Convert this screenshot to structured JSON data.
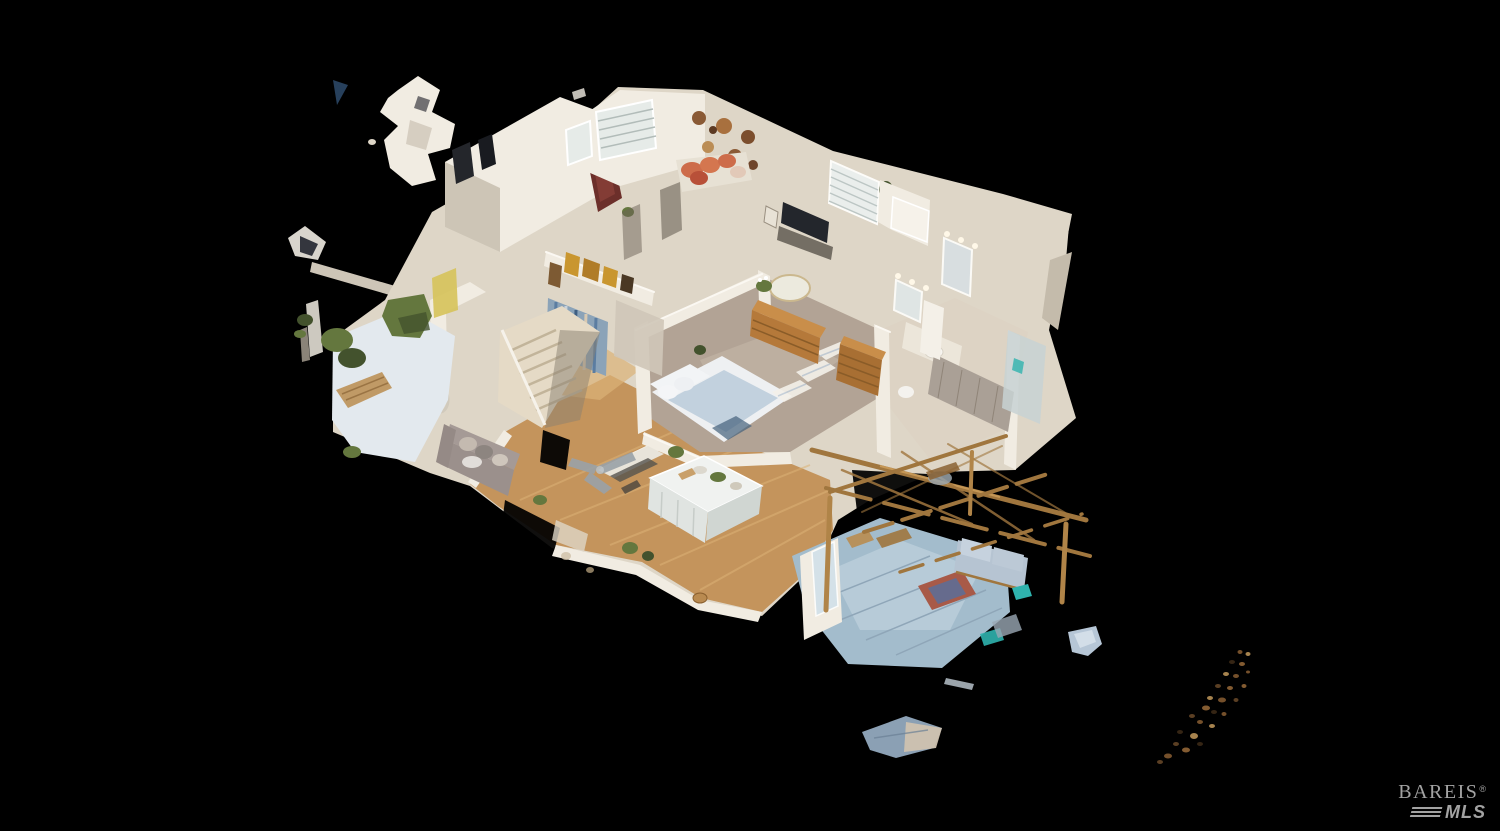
{
  "canvas": {
    "width_px": 1500,
    "height_px": 831,
    "background": "#000000"
  },
  "scene": {
    "type": "3d-dollhouse-view",
    "subject": "Cutaway 3D dollhouse scan of a single-story home floating on a black void, viewed from an elevated three-quarter angle, with stray point-cloud fragments scattered around the edges",
    "rooms_visible": [
      "front porch with wood bench and green shrubs",
      "entry hall with staircase",
      "walk-in closet with shelf of gold shopping bags and hanging clothes",
      "back bedroom with orange throw pillows, window blinds and wall baskets",
      "media room with wall-mounted TV and plantation-shutter window",
      "primary bedroom with white and blue bed, wood dressers, mirror and carpet",
      "bathroom with vanity mirrors, sink and shower",
      "kitchen with white island on wood flooring",
      "living area with gray sofa",
      "covered patio with wood pergola, outdoor sofa, rug and teal accents"
    ]
  },
  "watermark": {
    "brand": "BAREIS",
    "registered_mark": "®",
    "sub_brand": "MLS",
    "color": "#c6c6c6"
  },
  "palette": {
    "background": "#000000",
    "wall_light": "#f1ece2",
    "wall_mid": "#ded6c7",
    "wall_shadow": "#c4bbab",
    "wall_dark": "#a39a8a",
    "floor_wood": "#c4945c",
    "floor_wood_light": "#dcb277",
    "carpet": "#b2a395",
    "carpet_light": "#c8bbac",
    "bed_white": "#eef0f2",
    "bed_blue": "#bfcfdc",
    "pillow_orange": "#cd6c4a",
    "wood_furniture": "#b5793a",
    "pergola_wood": "#a0763e",
    "patio_blue": "#a3bccc",
    "patio_blue_light": "#c4d6e0",
    "greenery": "#64773e",
    "greenery_dark": "#43522d",
    "teal_accent": "#2fb3ae",
    "maroon_art": "#6c2f2a",
    "denim_blue": "#8ba3b8",
    "gold_bag": "#c9962f",
    "couch_gray": "#9b908c",
    "watermark_gray": "#c6c6c6"
  }
}
